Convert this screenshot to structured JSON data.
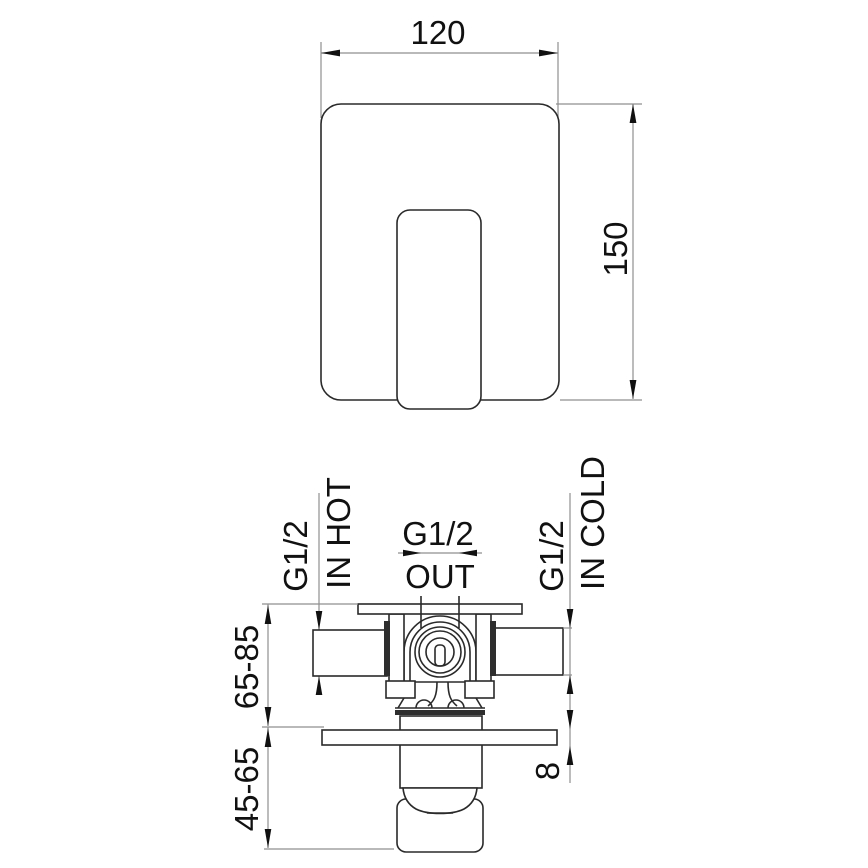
{
  "drawing": {
    "type": "technical-installation-drawing",
    "subject": "concealed shower mixer valve",
    "top_view": {
      "width_dim": "120",
      "height_dim": "150"
    },
    "bottom_view": {
      "hot_inlet_thread": "G1/2",
      "hot_inlet_label": "IN HOT",
      "outlet_thread": "G1/2",
      "outlet_label": "OUT",
      "cold_inlet_thread": "G1/2",
      "cold_inlet_label": "IN COLD",
      "install_depth_range": "65-85",
      "trim_depth_range": "45-65",
      "plate_thickness": "8"
    },
    "colors": {
      "outline": "#2a2a2a",
      "dimension_line": "#8f8f8f",
      "text": "#111111",
      "background": "#ffffff"
    }
  }
}
